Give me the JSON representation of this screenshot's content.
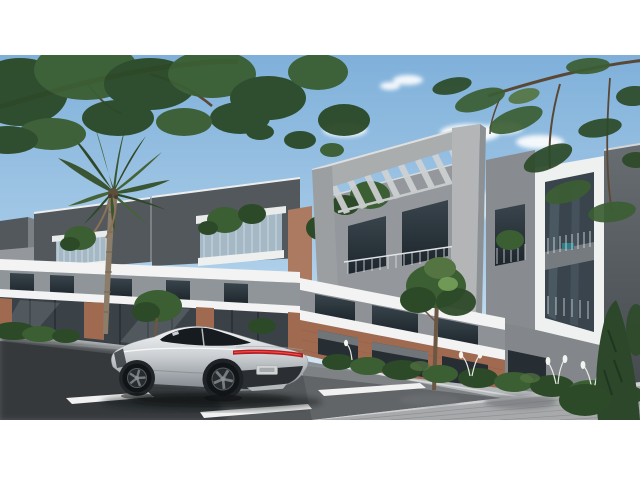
{
  "scene": {
    "alt": "Architectural rendering of a modern two-storey townhouse complex with rooftop pergolas and glass balconies, a silver sports car parked on the street in front, a palm tree and overhanging branches framing the view",
    "labels": {
      "building": "Modern townhouse complex",
      "pergola": "Rooftop concrete pergola frame",
      "car": "Silver sports car",
      "palm": "Palm tree",
      "street": "Street and paved plaza",
      "trees": "Overhanging tree branches",
      "vegetation": "Shrubs and ornamental grasses"
    }
  },
  "colors": {
    "background_white": "#ffffff",
    "sky_top": "#7fb0da",
    "sky_mid": "#a9cce8",
    "sky_horizon": "#e9f2f8",
    "cloud": "#ffffff",
    "panel_dark": "#53585d",
    "concrete_mid": "#94989c",
    "concrete_light": "#aaadae",
    "side_face": "#7b8085",
    "band_white": "#f2f3f2",
    "frame_white": "#eff0f0",
    "glass_dark": "#39444c",
    "glass_deep": "#1d262c",
    "storefront_glass": "#3a4248",
    "terrace_glass": "#a4b8c5",
    "railing_glass": "#d9dee2",
    "brick": "#a06a50",
    "brick_light": "#ab7a60",
    "foliage_dark": "#2c4a28",
    "foliage_mid": "#3b5e33",
    "foliage_light": "#547542",
    "conifer": "#2c4729",
    "trunk_brown": "#6b5744",
    "branch_brown": "#5a4836",
    "palm_trunk": "#8b7d6a",
    "road": "#55585b",
    "road_shadow": "#2f3235",
    "sidewalk": "#b5b8ba",
    "plaza": "#a7a9ab",
    "curb": "#cfd1d2",
    "lane_mark": "#f0f1f0",
    "car_highlight": "#f4f5f6",
    "car_silver": "#cdd1d4",
    "car_mid": "#9aa0a5",
    "car_shadow_tone": "#7e858a",
    "car_glass": "#161b1f",
    "taillight_red": "#b01f26",
    "taillight_bright": "#ff4f43",
    "bumper_dark": "#2b2f33",
    "wheel_dark": "#121517",
    "spoke_gray": "#757b80",
    "plate": "#d2d4d4",
    "panel_grad_top": "#686d72",
    "panel_grad_bottom": "#41464b",
    "teal_accent": "#2e7d86"
  }
}
